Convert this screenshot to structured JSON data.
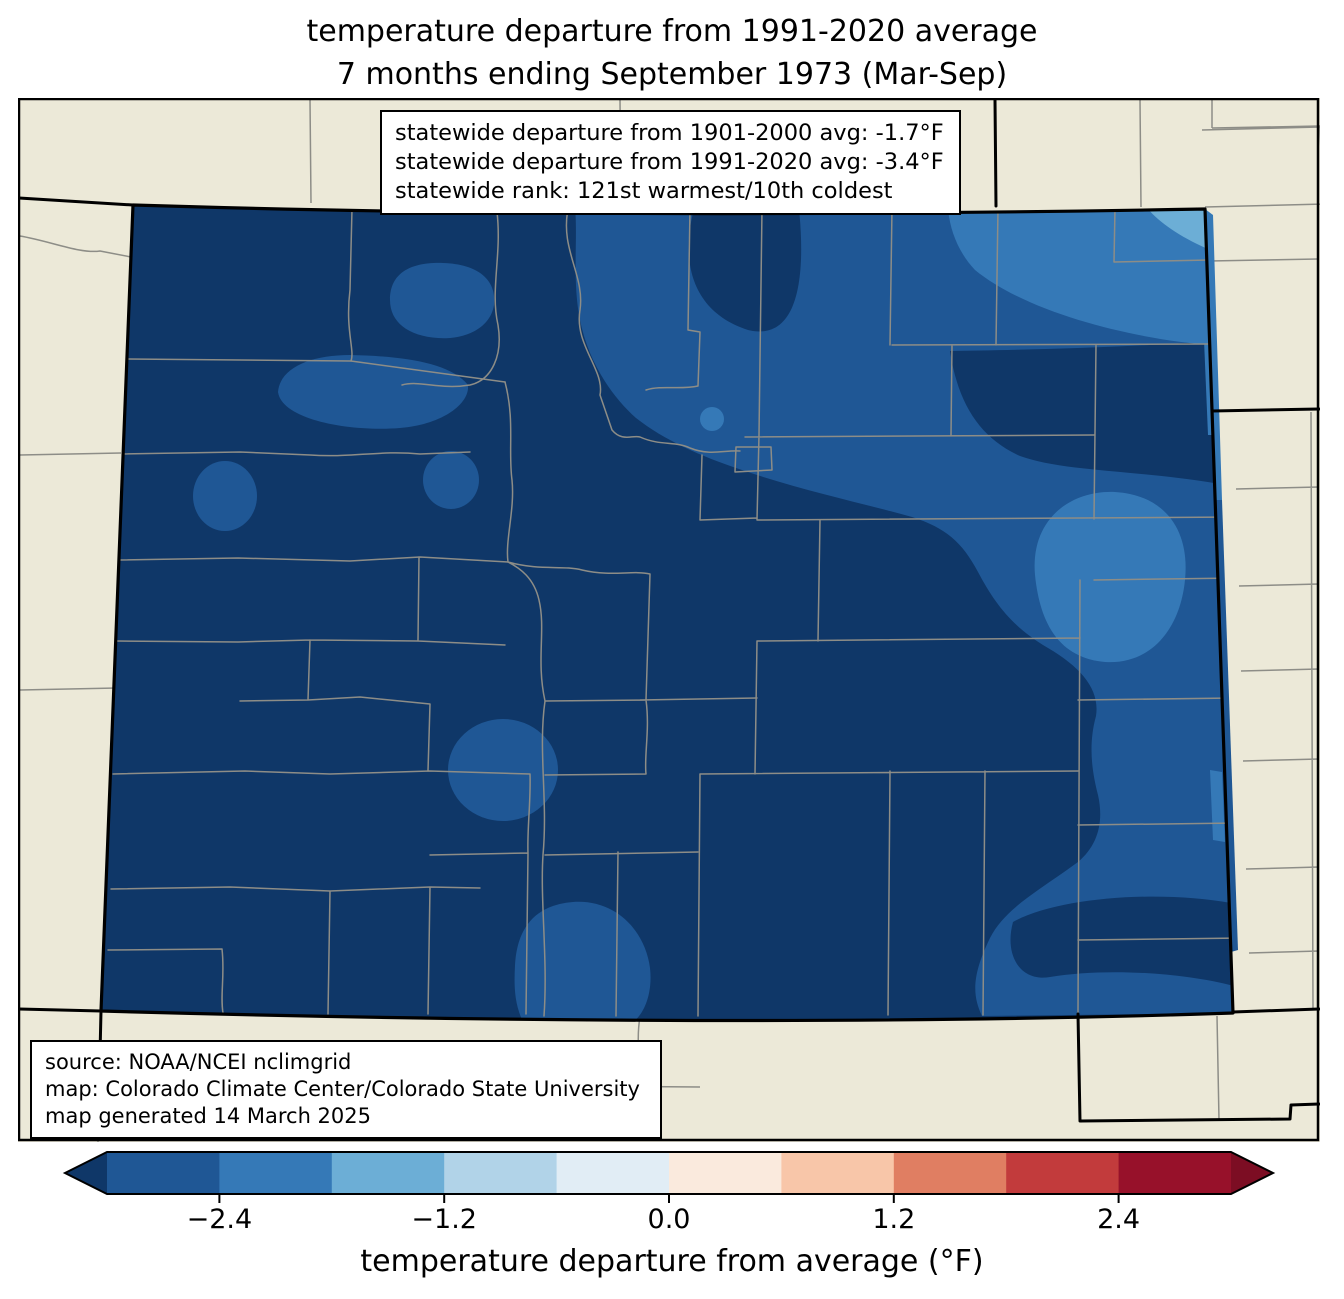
{
  "title": {
    "line1": "temperature departure from 1991-2020 average",
    "line2": "7 months ending September 1973 (Mar-Sep)"
  },
  "stats_box": {
    "line1": "statewide departure from 1901-2000 avg: -1.7°F",
    "line2": "statewide departure from 1991-2020 avg: -3.4°F",
    "line3": "statewide rank: 121st warmest/10th coldest"
  },
  "source_box": {
    "line1": "source: NOAA/NCEI nclimgrid",
    "line2": "map: Colorado Climate Center/Colorado State University",
    "line3": "map generated 14 March 2025"
  },
  "colorbar": {
    "label": "temperature departure from average (°F)",
    "under_color": "#0f3768",
    "over_color": "#7c0d23",
    "segments": [
      "#1f5795",
      "#3579b7",
      "#6caed6",
      "#b1d3e8",
      "#e1edf5",
      "#faeadd",
      "#f8c6a9",
      "#e07e62",
      "#c23b3c",
      "#97112a"
    ],
    "ticks": [
      {
        "label": "−2.4",
        "frac": 0.1
      },
      {
        "label": "−1.2",
        "frac": 0.3
      },
      {
        "label": "0.0",
        "frac": 0.5
      },
      {
        "label": "1.2",
        "frac": 0.7
      },
      {
        "label": "2.4",
        "frac": 0.9
      }
    ]
  },
  "map": {
    "region": "Colorado",
    "palette": {
      "beige": "#ece9d8",
      "navy": "#0f3768",
      "b1": "#1f5795",
      "b2": "#3579b7",
      "b3": "#6caed6",
      "county": "#8d8d87",
      "border": "#000000"
    }
  }
}
